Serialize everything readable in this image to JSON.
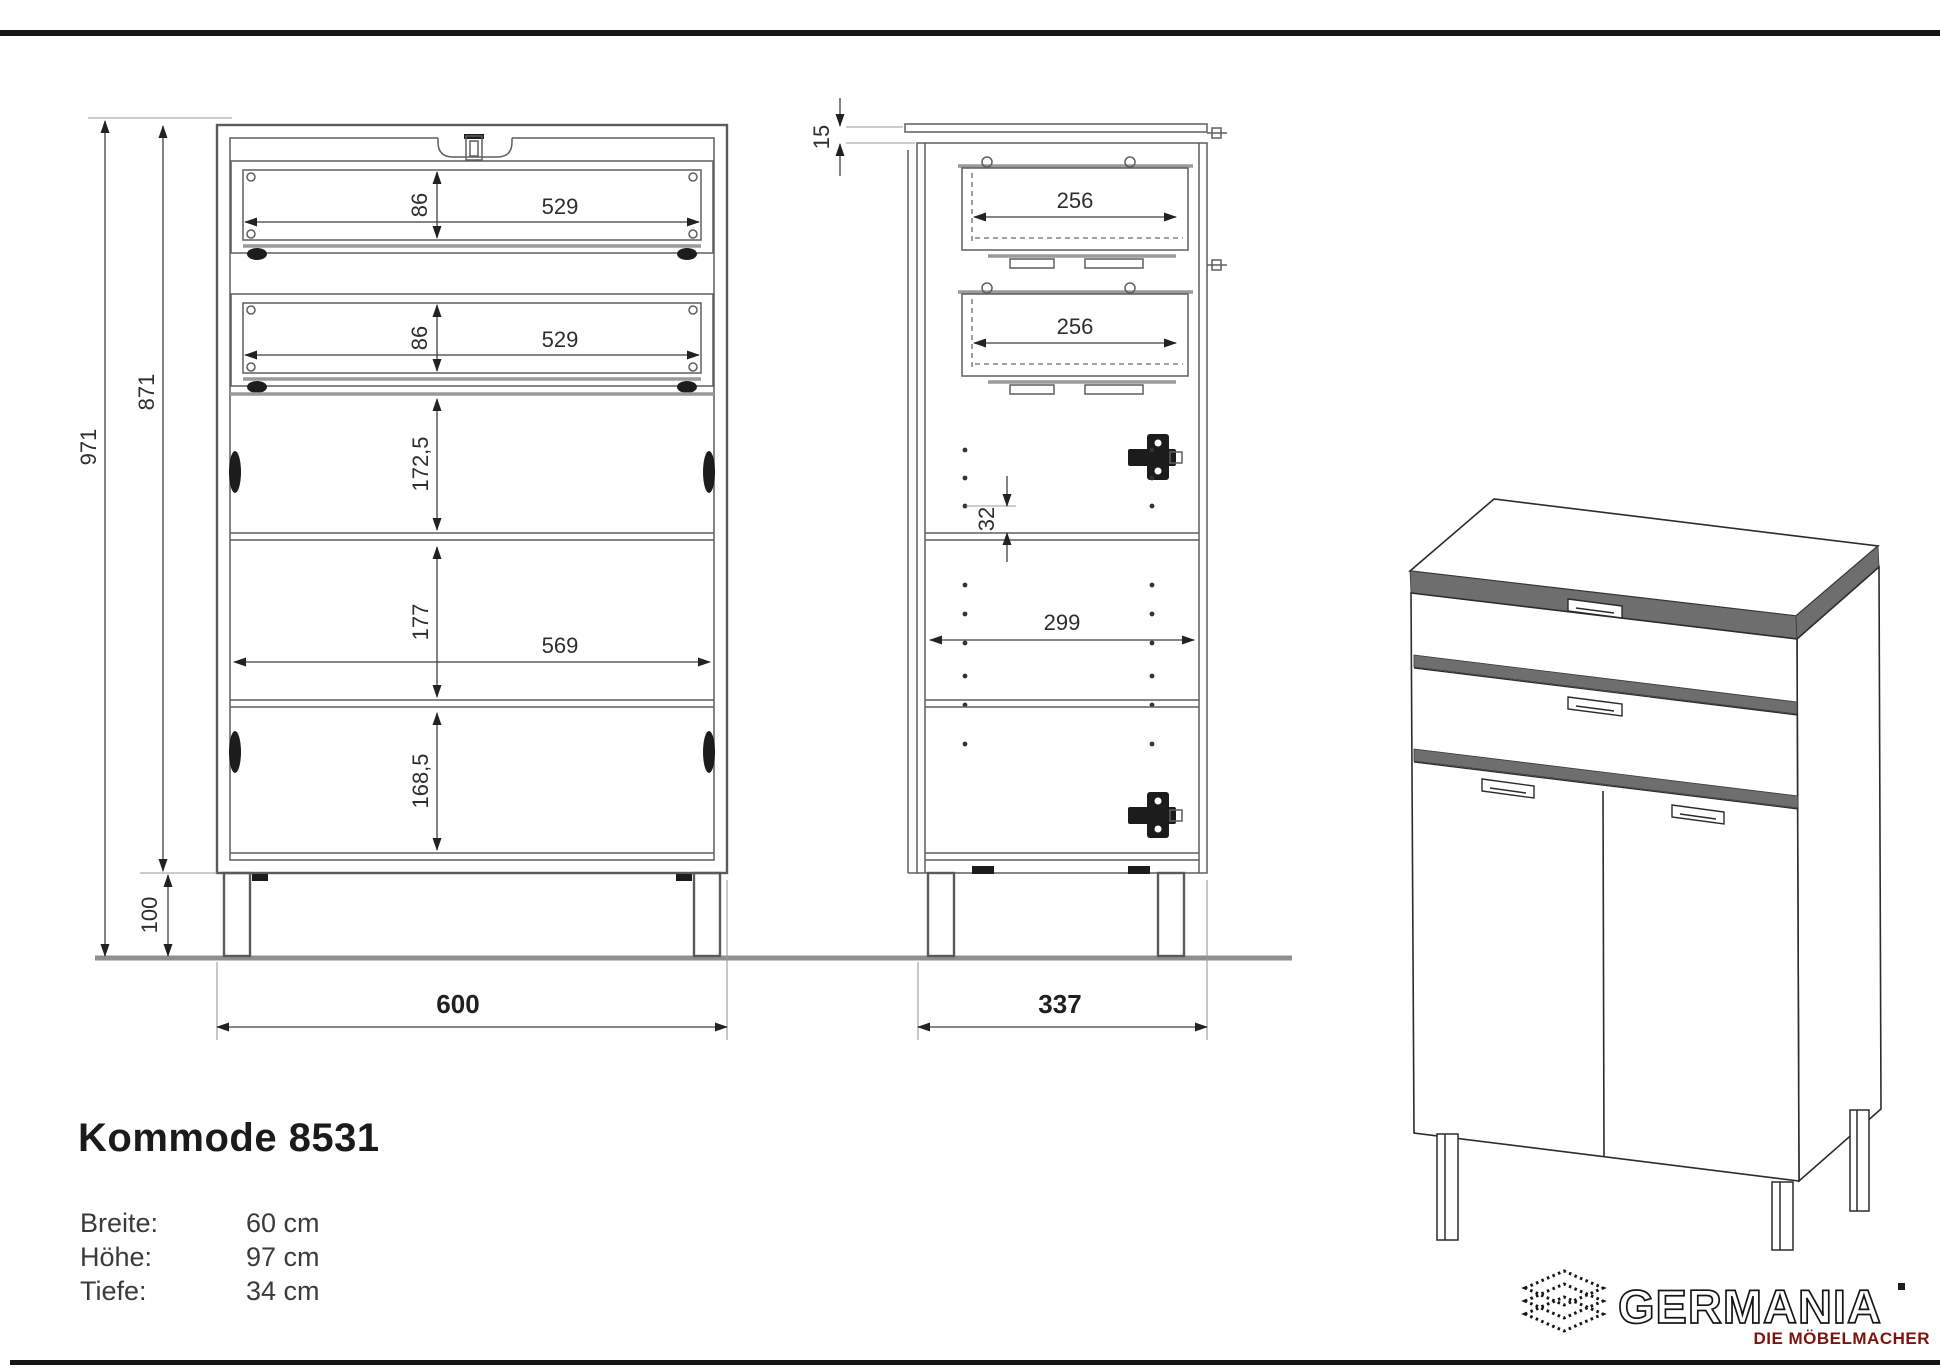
{
  "title": "Kommode 8531",
  "specs": {
    "rows": [
      {
        "label": "Breite:",
        "value": "60 cm"
      },
      {
        "label": "Höhe:",
        "value": "97 cm"
      },
      {
        "label": "Tiefe:",
        "value": "34 cm"
      }
    ]
  },
  "views": {
    "front": {
      "dims": {
        "total_height": "971",
        "carcass_height": "871",
        "leg_height": "100",
        "drawer1_height": "86",
        "drawer1_width": "529",
        "drawer2_height": "86",
        "drawer2_width": "529",
        "upper_compartment": "172,5",
        "middle_compartment": "177",
        "interior_width": "569",
        "lower_compartment": "168,5",
        "total_width": "600"
      }
    },
    "side": {
      "dims": {
        "top_overhang": "15",
        "drawer1_depth": "256",
        "drawer2_depth": "256",
        "hole_pitch": "32",
        "interior_depth": "299",
        "total_depth": "337"
      }
    }
  },
  "brand": {
    "name": "GERMANIA",
    "tagline": "DIE MÖBELMACHER",
    "tagline_color": "#7c130c",
    "logo_color": "#151515"
  }
}
